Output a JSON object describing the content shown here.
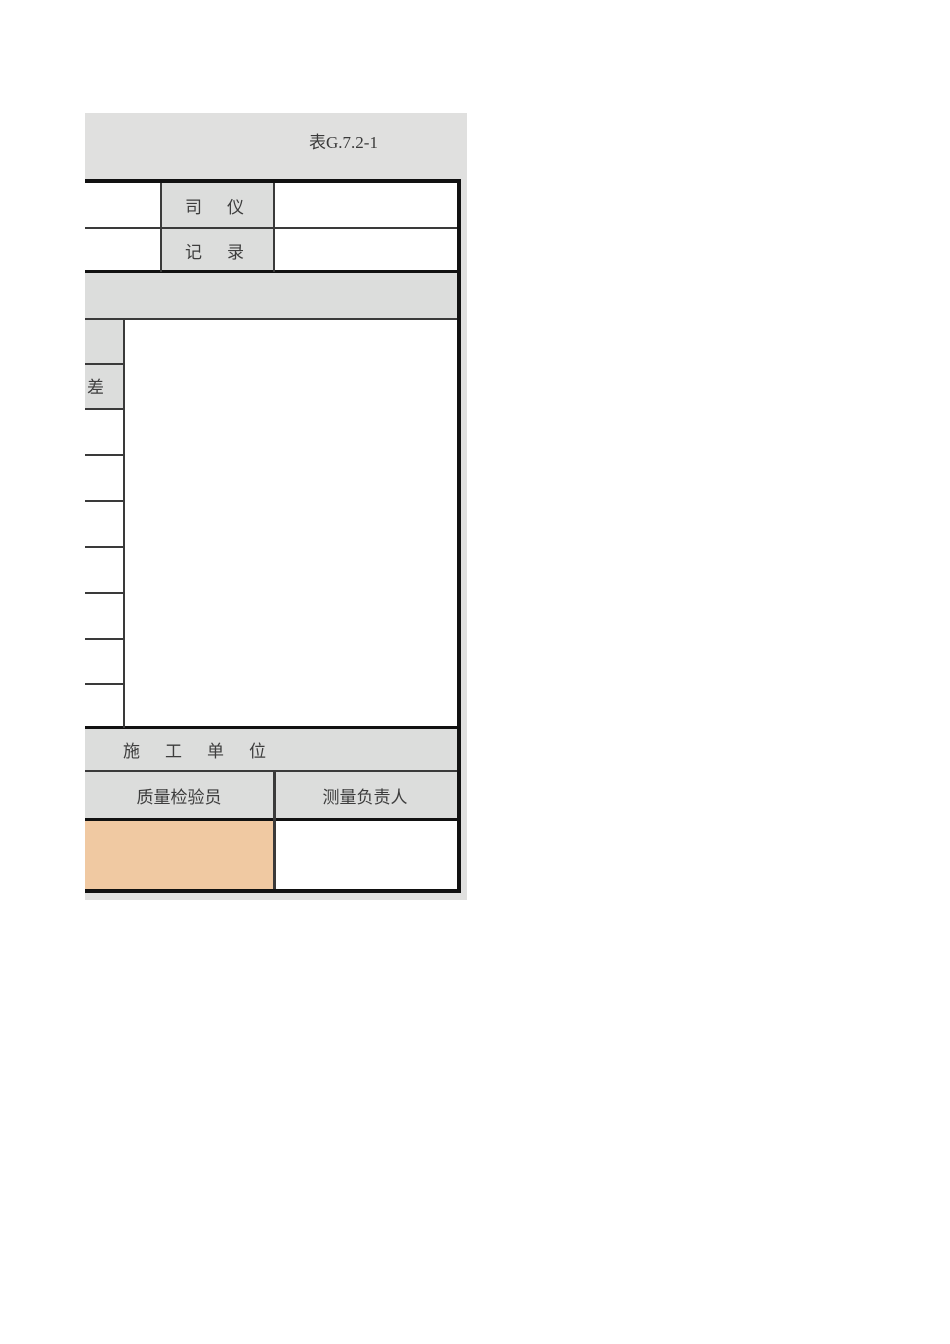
{
  "form": {
    "table_code": "表G.7.2-1",
    "personnel_rows": [
      {
        "label": "司　仪",
        "value": ""
      },
      {
        "label": "记　录",
        "value": ""
      }
    ],
    "measurement_grid": {
      "left_header_partial": "差",
      "empty_left_rows": 7,
      "main_area_value": ""
    },
    "footer": {
      "section_label": "施　工　单　位",
      "sign_columns": [
        {
          "header": "质量检验员",
          "value": "",
          "highlighted": true
        },
        {
          "header": "测量负责人",
          "value": "",
          "highlighted": false
        }
      ]
    },
    "colors": {
      "backdrop_gray": "#e0e0df",
      "cell_gray": "#dcdddc",
      "highlight_orange": "#f0c9a2",
      "thin_line": "#3a3a3a",
      "thick_line": "#111111"
    }
  }
}
